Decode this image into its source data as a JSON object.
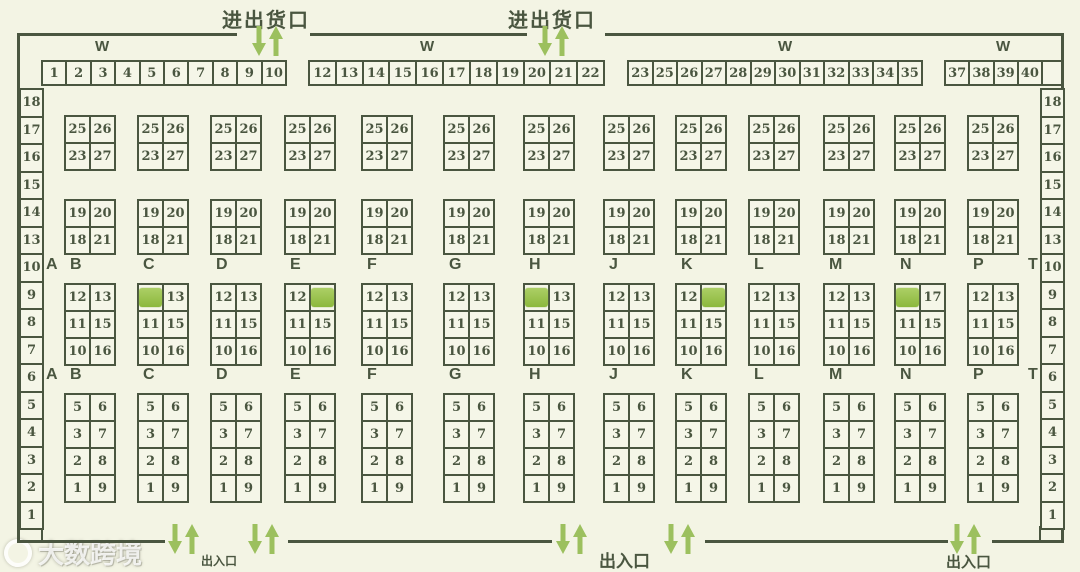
{
  "colors": {
    "background": "#f3f4e4",
    "ink": "#4a5640",
    "arrow_green": "#9cc05e",
    "stall_selected": "#93bd44"
  },
  "legend": {
    "top_dock_label": "进出货口",
    "bottom_entrance_label": "出入口",
    "wing_label": "W"
  },
  "top_row_groups": [
    [
      "1",
      "2",
      "3",
      "4",
      "5",
      "6",
      "7",
      "8",
      "9",
      "10"
    ],
    [
      "12",
      "13",
      "14",
      "15",
      "16",
      "17",
      "18",
      "19",
      "20",
      "21",
      "22"
    ],
    [
      "23",
      "25",
      "26",
      "27",
      "28",
      "29",
      "30",
      "31",
      "32",
      "33",
      "34",
      "35"
    ],
    [
      "37",
      "38",
      "39",
      "40"
    ]
  ],
  "left_strip": [
    "18",
    "17",
    "16",
    "15",
    "14",
    "13",
    "10",
    "9",
    "8",
    "7",
    "6",
    "5",
    "4",
    "3",
    "2",
    "1"
  ],
  "right_strip": [
    "18",
    "17",
    "16",
    "15",
    "14",
    "13",
    "10",
    "9",
    "8",
    "7",
    "6",
    "5",
    "4",
    "3",
    "2",
    "1"
  ],
  "aisle_letters_row1": [
    "A",
    "B",
    "C",
    "D",
    "E",
    "F",
    "G",
    "H",
    "J",
    "K",
    "L",
    "M",
    "N",
    "P",
    "T"
  ],
  "aisle_letters_row2": [
    "A",
    "B",
    "C",
    "D",
    "E",
    "F",
    "G",
    "H",
    "J",
    "K",
    "L",
    "M",
    "N",
    "P",
    "T"
  ],
  "upper_block_rows": [
    [
      "25",
      "26"
    ],
    [
      "23",
      "27"
    ]
  ],
  "second_block_rows": [
    [
      "19",
      "20"
    ],
    [
      "18",
      "21"
    ]
  ],
  "lower_block_rows": [
    [
      "5",
      "6"
    ],
    [
      "3",
      "7"
    ],
    [
      "2",
      "8"
    ],
    [
      "1",
      "9"
    ]
  ],
  "mid_blocks": [
    {
      "column": "B",
      "rows": [
        [
          "12",
          "13"
        ],
        [
          "11",
          "15"
        ],
        [
          "10",
          "16"
        ]
      ],
      "selected": null
    },
    {
      "column": "C",
      "rows": [
        [
          "",
          "13"
        ],
        [
          "11",
          "15"
        ],
        [
          "10",
          "16"
        ]
      ],
      "selected": [
        0,
        0
      ]
    },
    {
      "column": "D",
      "rows": [
        [
          "12",
          "13"
        ],
        [
          "11",
          "15"
        ],
        [
          "10",
          "16"
        ]
      ],
      "selected": null
    },
    {
      "column": "E",
      "rows": [
        [
          "12",
          ""
        ],
        [
          "11",
          "15"
        ],
        [
          "10",
          "16"
        ]
      ],
      "selected": [
        0,
        1
      ]
    },
    {
      "column": "F",
      "rows": [
        [
          "12",
          "13"
        ],
        [
          "11",
          "15"
        ],
        [
          "10",
          "16"
        ]
      ],
      "selected": null
    },
    {
      "column": "G",
      "rows": [
        [
          "12",
          "13"
        ],
        [
          "11",
          "15"
        ],
        [
          "10",
          "16"
        ]
      ],
      "selected": null
    },
    {
      "column": "H",
      "rows": [
        [
          "",
          "13"
        ],
        [
          "11",
          "15"
        ],
        [
          "10",
          "16"
        ]
      ],
      "selected": [
        0,
        0
      ]
    },
    {
      "column": "J",
      "rows": [
        [
          "12",
          "13"
        ],
        [
          "11",
          "15"
        ],
        [
          "10",
          "16"
        ]
      ],
      "selected": null
    },
    {
      "column": "K",
      "rows": [
        [
          "12",
          ""
        ],
        [
          "11",
          "15"
        ],
        [
          "10",
          "16"
        ]
      ],
      "selected": [
        0,
        1
      ]
    },
    {
      "column": "L",
      "rows": [
        [
          "12",
          "13"
        ],
        [
          "11",
          "15"
        ],
        [
          "10",
          "16"
        ]
      ],
      "selected": null
    },
    {
      "column": "M",
      "rows": [
        [
          "12",
          "13"
        ],
        [
          "11",
          "15"
        ],
        [
          "10",
          "16"
        ]
      ],
      "selected": null
    },
    {
      "column": "N",
      "rows": [
        [
          "",
          "17"
        ],
        [
          "11",
          "15"
        ],
        [
          "10",
          "16"
        ]
      ],
      "selected": [
        0,
        0
      ]
    },
    {
      "column": "P",
      "rows": [
        [
          "12",
          "13"
        ],
        [
          "11",
          "15"
        ],
        [
          "10",
          "16"
        ]
      ],
      "selected": null
    }
  ],
  "watermark": {
    "text": "大数跨境"
  }
}
